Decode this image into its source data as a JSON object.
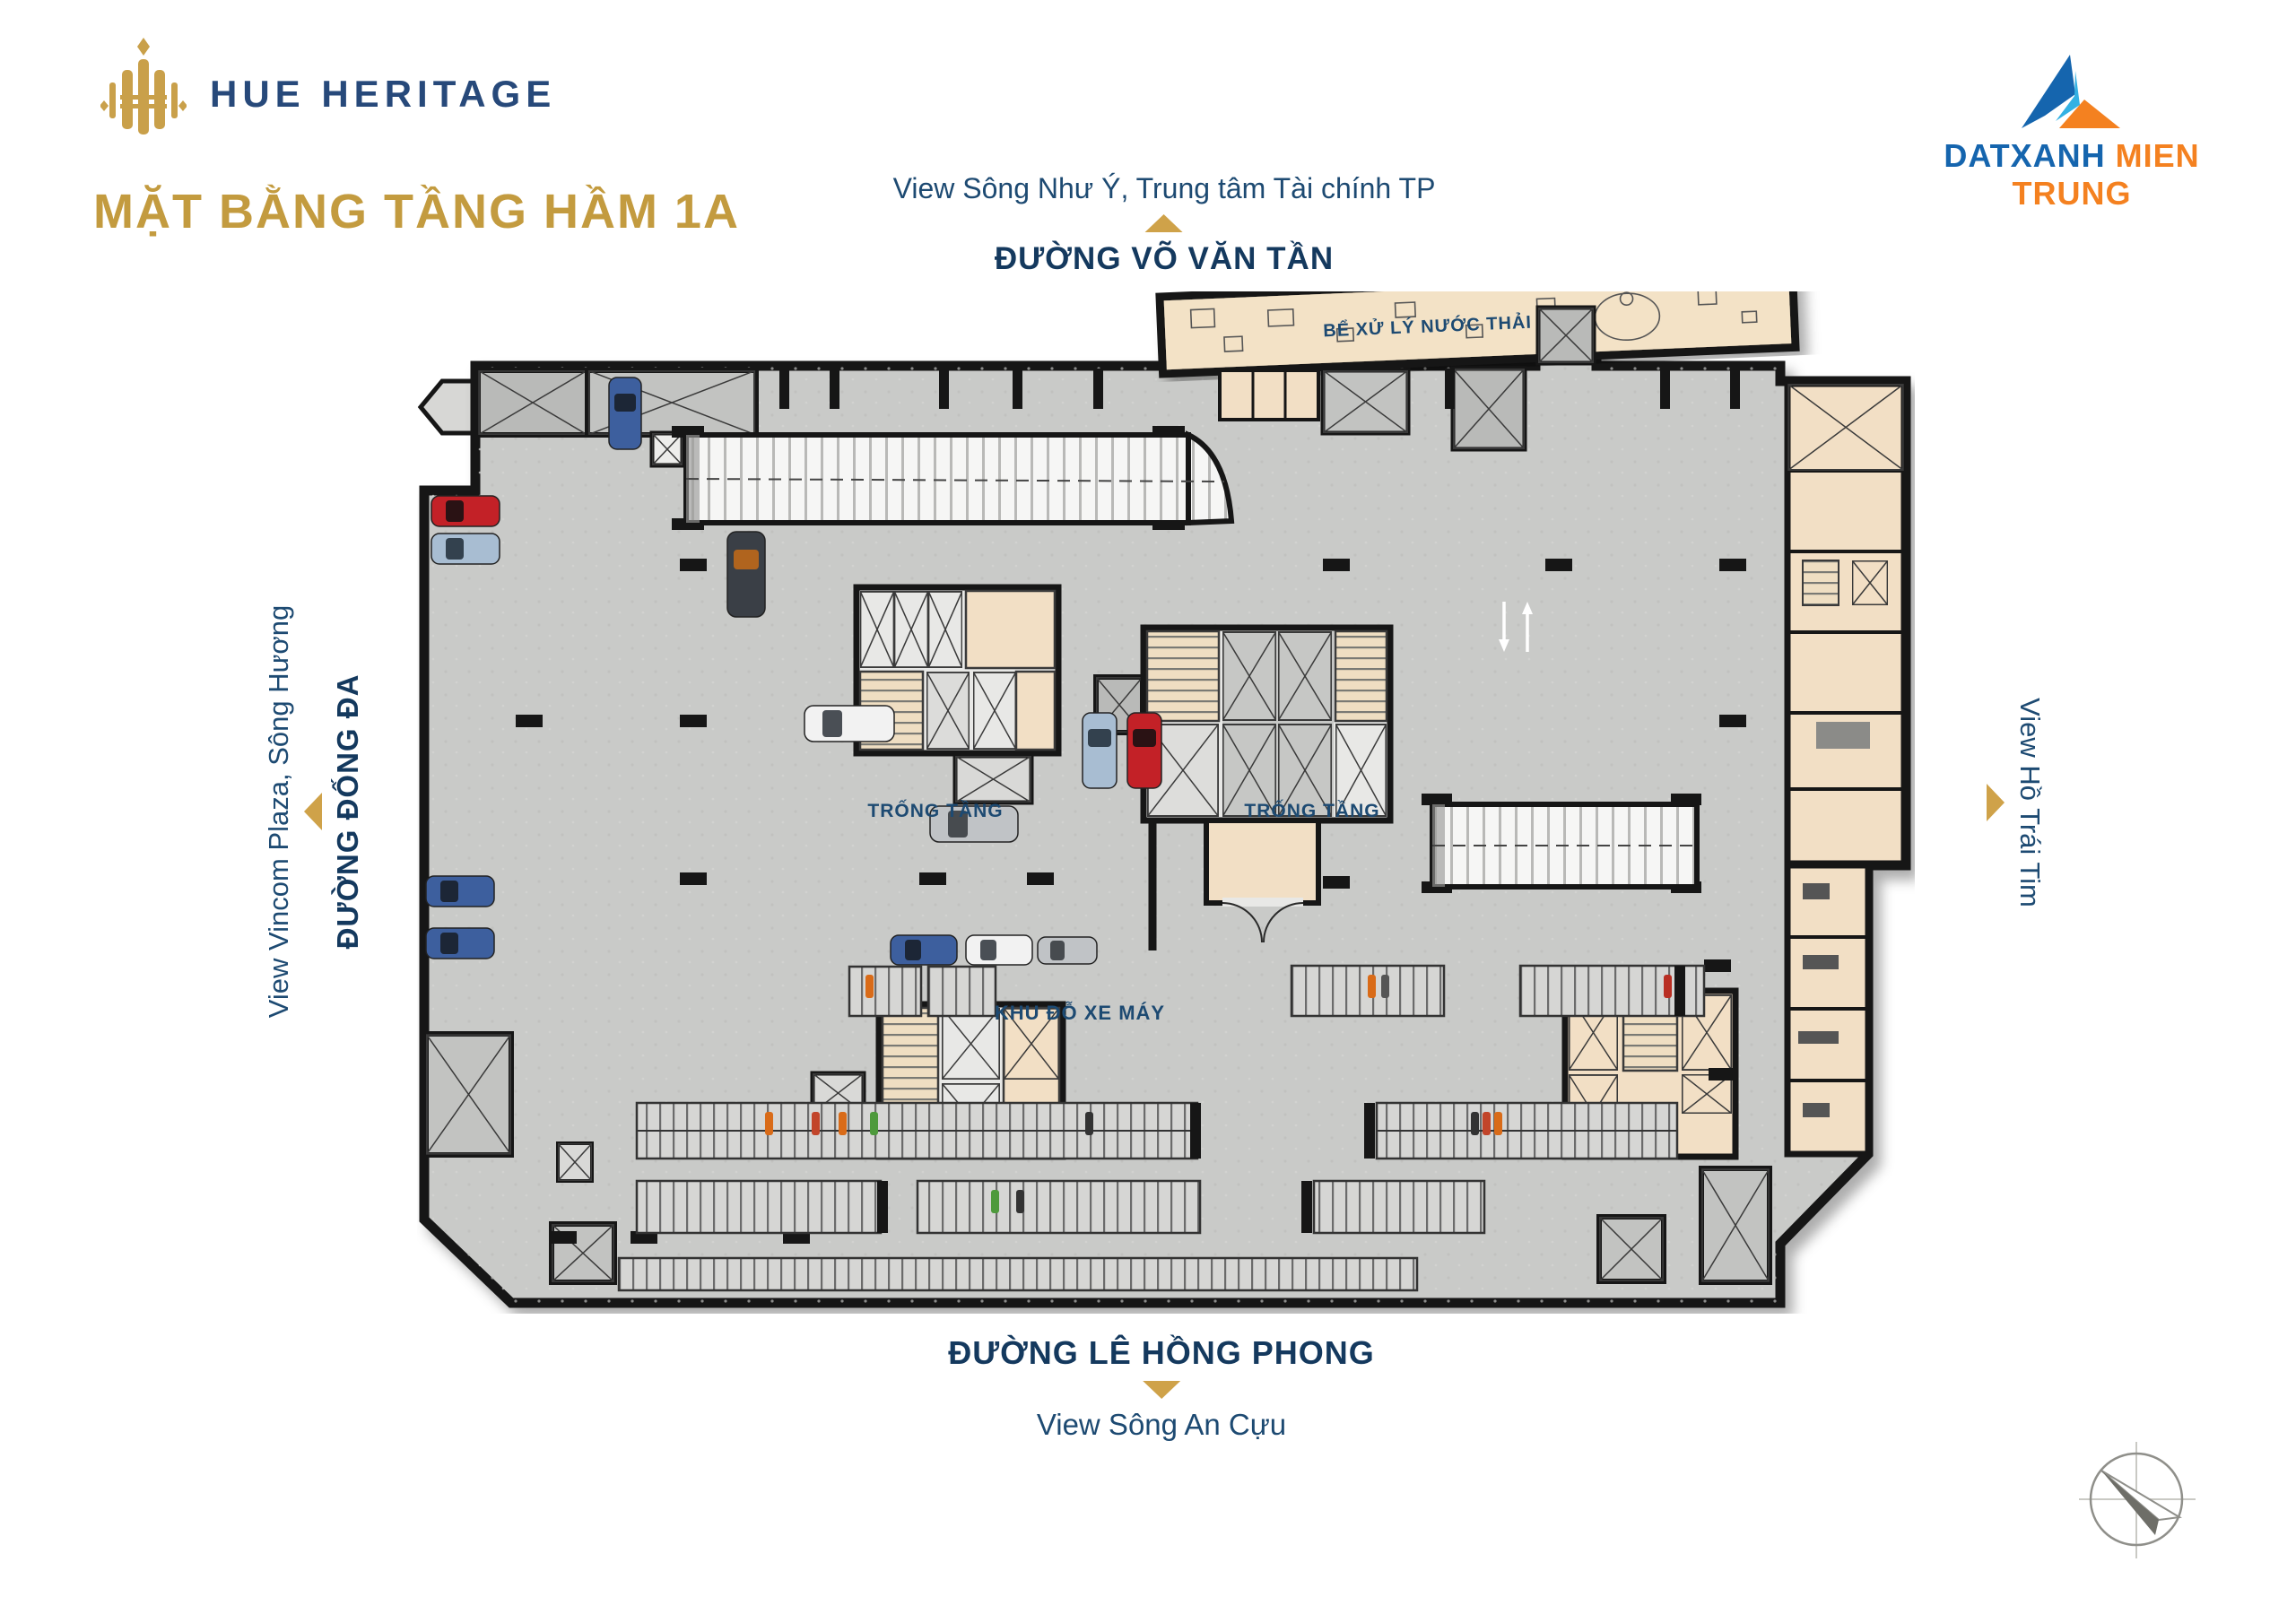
{
  "header": {
    "project_name": "HUE HERITAGE",
    "page_title": "MẶT BẰNG TẦNG HẦM 1A",
    "developer_name_part1": "DATXANH",
    "developer_name_part2": "MIEN TRUNG"
  },
  "directions": {
    "top_view": "View Sông Như Ý, Trung tâm Tài chính TP",
    "top_street": "ĐƯỜNG VÕ VĂN TẦN",
    "left_view": "View Vincom Plaza, Sông Hương",
    "left_street": "ĐƯỜNG ĐỐNG ĐA",
    "right_view": "View Hồ Trái Tim",
    "bottom_street": "ĐƯỜNG LÊ HỒNG PHONG",
    "bottom_view": "View Sông An Cựu"
  },
  "plan": {
    "label_waste_tank": "BỂ XỬ LÝ NƯỚC THẢI",
    "label_void_1": "TRỐNG TẦNG",
    "label_void_2": "TRỐNG TẦNG",
    "label_motorbike": "KHU ĐỖ XE MÁY"
  },
  "icons": {
    "compass": "north-arrow-compass",
    "direction_marker": "gold-triangle-arrow",
    "project_logo": "gold-building-emblem",
    "developer_logo": "blue-orange-mountain-triangle"
  },
  "colors": {
    "accent_gold": "#C39B3F",
    "navy_text": "#1D4A72",
    "brand_blue": "#1565AE",
    "brand_light_blue": "#33B1E3",
    "brand_orange": "#F48120",
    "floor_gray": "#C9CAC8",
    "room_beige": "#F2DFC5",
    "wall_black": "#161616"
  }
}
